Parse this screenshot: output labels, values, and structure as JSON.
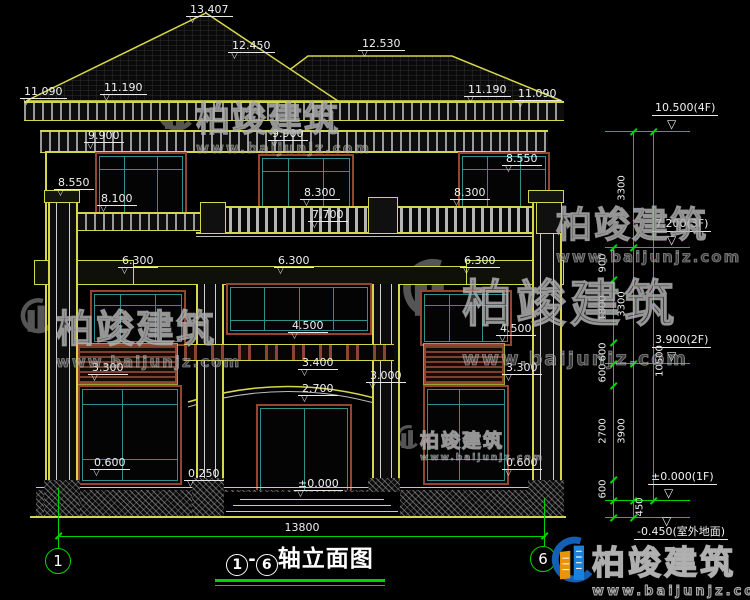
{
  "meta": {
    "drawing_type": "house front elevation CAD drawing",
    "background": "#000000"
  },
  "colors": {
    "line_yellow": "#d6d64a",
    "line_green": "#00d400",
    "line_white": "#e8e8e8",
    "frame_teal": "#2f8f8f",
    "frame_brown": "#94442f",
    "text_white": "#f0f0f0",
    "watermark_gray": "#9b9b9b",
    "logo_blue": "#1565c0",
    "logo_orange": "#f59e0b"
  },
  "title_block": {
    "axis_start": "1",
    "axis_end": "6",
    "dash": "-",
    "text": "轴立面图"
  },
  "bottom": {
    "overall_dim": "13800",
    "axis_left": "1",
    "axis_right": "6"
  },
  "watermark": {
    "brand": "柏竣建筑",
    "url": "www.baijunjz.com"
  },
  "facade_levels": [
    {
      "label": "13.407",
      "x": 186,
      "y": 4
    },
    {
      "label": "12.450",
      "x": 228,
      "y": 40
    },
    {
      "label": "12.530",
      "x": 358,
      "y": 38
    },
    {
      "label": "11.090",
      "x": 20,
      "y": 86
    },
    {
      "label": "11.190",
      "x": 100,
      "y": 82
    },
    {
      "label": "11.190",
      "x": 464,
      "y": 84
    },
    {
      "label": "11.090",
      "x": 514,
      "y": 88
    },
    {
      "label": "9.900",
      "x": 84,
      "y": 130
    },
    {
      "label": "9.900",
      "x": 268,
      "y": 128
    },
    {
      "label": "8.550",
      "x": 54,
      "y": 177
    },
    {
      "label": "8.100",
      "x": 97,
      "y": 193
    },
    {
      "label": "8.300",
      "x": 300,
      "y": 187
    },
    {
      "label": "8.300",
      "x": 450,
      "y": 187
    },
    {
      "label": "8.550",
      "x": 502,
      "y": 153
    },
    {
      "label": "7.700",
      "x": 308,
      "y": 209
    },
    {
      "label": "6.300",
      "x": 118,
      "y": 255
    },
    {
      "label": "6.300",
      "x": 274,
      "y": 255
    },
    {
      "label": "6.300",
      "x": 460,
      "y": 255
    },
    {
      "label": "4.500",
      "x": 288,
      "y": 320
    },
    {
      "label": "4.500",
      "x": 496,
      "y": 323
    },
    {
      "label": "3.400",
      "x": 298,
      "y": 357
    },
    {
      "label": "3.000",
      "x": 366,
      "y": 370
    },
    {
      "label": "2.700",
      "x": 298,
      "y": 383
    },
    {
      "label": "3.300",
      "x": 88,
      "y": 362
    },
    {
      "label": "3.300",
      "x": 502,
      "y": 362
    },
    {
      "label": "0.600",
      "x": 90,
      "y": 457
    },
    {
      "label": "0.600",
      "x": 502,
      "y": 457
    },
    {
      "label": "0.250",
      "x": 184,
      "y": 468
    },
    {
      "label": "±0.000",
      "x": 294,
      "y": 478
    }
  ],
  "right_levels": [
    {
      "label": "10.500(4F)",
      "text_x": 652,
      "text_y": 102,
      "line_y": 131,
      "tri_x": 667,
      "tri_y": 118
    },
    {
      "label": "7.200(3F)",
      "text_x": 652,
      "text_y": 218,
      "line_y": 247,
      "tri_x": 667,
      "tri_y": 234
    },
    {
      "label": "3.900(2F)",
      "text_x": 652,
      "text_y": 334,
      "line_y": 363,
      "tri_x": 667,
      "tri_y": 350
    },
    {
      "label": "±0.000(1F)",
      "text_x": 648,
      "text_y": 471,
      "line_y": 500,
      "tri_x": 664,
      "tri_y": 487
    },
    {
      "label": "-0.450(室外地面)",
      "text_x": 634,
      "text_y": 526,
      "line_y": 517,
      "tri_x": 662,
      "tri_y": 515
    }
  ],
  "vertical_dims": [
    {
      "label": "900",
      "x": 603,
      "y": 263
    },
    {
      "label": "1800",
      "x": 603,
      "y": 308
    },
    {
      "label": "600",
      "x": 603,
      "y": 352
    },
    {
      "label": "600",
      "x": 603,
      "y": 373
    },
    {
      "label": "2700",
      "x": 603,
      "y": 431
    },
    {
      "label": "600",
      "x": 603,
      "y": 489
    },
    {
      "label": "3300",
      "x": 622,
      "y": 188
    },
    {
      "label": "3300",
      "x": 622,
      "y": 304
    },
    {
      "label": "3900",
      "x": 622,
      "y": 431
    },
    {
      "label": "450",
      "x": 640,
      "y": 507
    },
    {
      "label": "10500",
      "x": 660,
      "y": 361
    }
  ]
}
